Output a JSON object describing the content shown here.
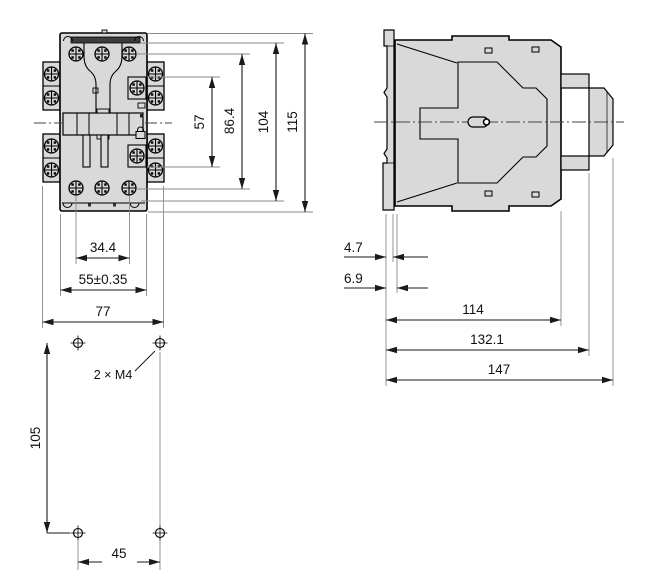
{
  "drawing_type": "technical-dimension-drawing",
  "front_view": {
    "vertical_dims": [
      {
        "label": "57"
      },
      {
        "label": "86.4"
      },
      {
        "label": "104"
      },
      {
        "label": "115"
      }
    ],
    "horizontal_dims": [
      {
        "label": "34.4"
      },
      {
        "label": "55±0.35"
      },
      {
        "label": "77"
      }
    ]
  },
  "side_view": {
    "offset_dims": [
      {
        "label": "4.7"
      },
      {
        "label": "6.9"
      }
    ],
    "depth_dims": [
      {
        "label": "114"
      },
      {
        "label": "132.1"
      },
      {
        "label": "147"
      }
    ]
  },
  "drill_plan": {
    "hole_label": "2 × M4",
    "vertical_dim": {
      "label": "105"
    },
    "horizontal_dim": {
      "label": "45"
    }
  },
  "icons": {
    "screw": "phillips-screw-head",
    "mounting_hole": "crosshair-drill-hole"
  },
  "colors": {
    "background": "#ffffff",
    "body_fill": "#d9d9d9",
    "outline": "#000000",
    "dim_line": "#1a1a1a",
    "extension_line": "#8a8a8a",
    "dark_bar": "#3c3c3c"
  }
}
